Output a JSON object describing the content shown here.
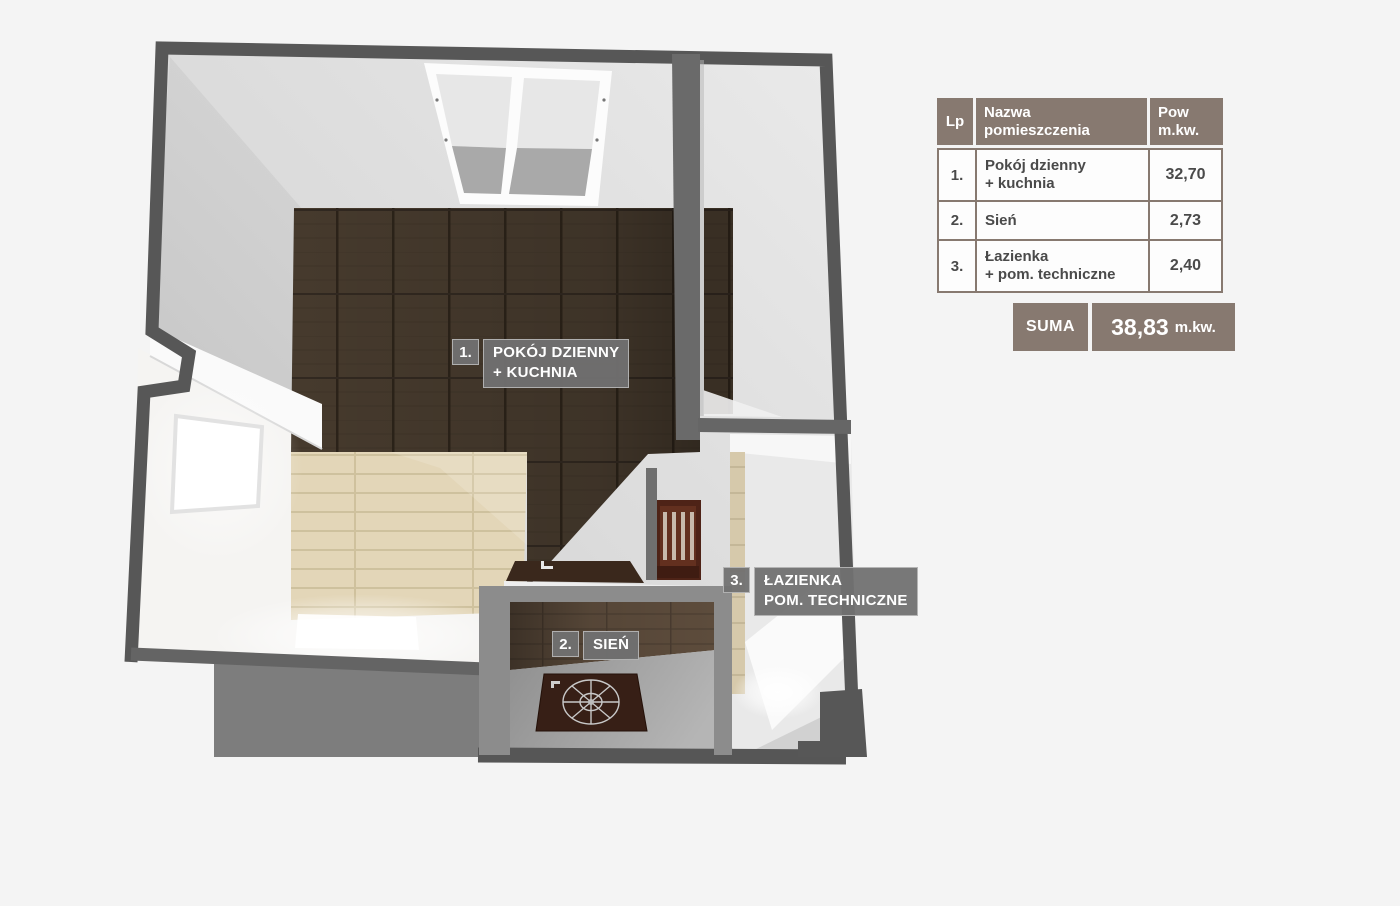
{
  "page": {
    "background": "#f4f4f4"
  },
  "floor_plan": {
    "labels": [
      {
        "num": "1.",
        "lines": [
          "POKÓJ DZIENNY",
          "+ KUCHNIA"
        ]
      },
      {
        "num": "2.",
        "lines": [
          "SIEŃ"
        ]
      },
      {
        "num": "3.",
        "lines": [
          "ŁAZIENKA",
          "POM. TECHNICZNE"
        ]
      }
    ],
    "colors": {
      "outer_wall": "#575757",
      "inner_wall": "#6a6a6a",
      "light_wall": "#8c8c8c",
      "dark_wood": "#463a2d",
      "beige_tile": "#e3d6b8",
      "entry_wood": "#5d4c3c",
      "mat": "#371f16",
      "label_gray": "#717171"
    }
  },
  "table": {
    "headers": {
      "lp": "Lp",
      "name_line1": "Nazwa",
      "name_line2": "pomieszczenia",
      "area_line1": "Pow",
      "area_line2": "m.kw."
    },
    "rows": [
      {
        "lp": "1.",
        "name_line1": "Pokój dzienny",
        "name_line2": "+ kuchnia",
        "area": "32,70"
      },
      {
        "lp": "2.",
        "name_line1": "Sień",
        "name_line2": "",
        "area": "2,73"
      },
      {
        "lp": "3.",
        "name_line1": "Łazienka",
        "name_line2": "+ pom. techniczne",
        "area": "2,40"
      }
    ],
    "sum": {
      "label": "SUMA",
      "value": "38,83",
      "unit": "m.kw."
    }
  }
}
